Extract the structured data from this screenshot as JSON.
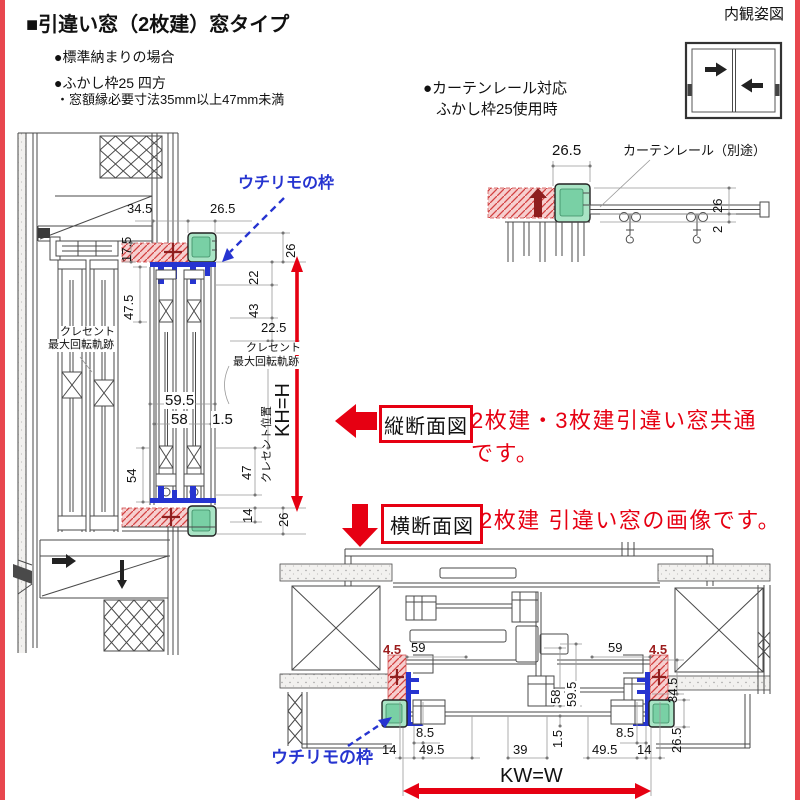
{
  "header": {
    "title": "■引違い窓（2枚建）窓タイプ",
    "bullet1": "●標準納まりの場合",
    "bullet2": "●ふかし枠25 四方",
    "note": "・窓額縁必要寸法35mm以上47mm未満"
  },
  "interior_view": {
    "label": "内観姿図"
  },
  "curtain": {
    "heading_line1": "●カーテンレール対応",
    "heading_line2": "ふかし枠25使用時",
    "dim_width": "26.5",
    "rail_label": "カーテンレール（別途）",
    "dim_26": "26",
    "dim_2": "2"
  },
  "vertical_section": {
    "uchirimo_label": "ウチリモの枠",
    "dim_34_5": "34.5",
    "dim_26_5": "26.5",
    "dim_17_5": "17.5",
    "dim_26_top": "26",
    "dim_22": "22",
    "dim_43": "43",
    "dim_47_5": "47.5",
    "dim_22_5": "22.5",
    "crescent_left_line1": "クレセント",
    "crescent_left_line2": "最大回転軌跡",
    "crescent_right_line1": "クレセント",
    "crescent_right_line2": "最大回転軌跡",
    "dim_59_5": "59.5",
    "dim_58": "58",
    "dim_1_5": "1.5",
    "dim_54": "54",
    "dim_47": "47",
    "crescent_pos_label": "クレセント位置",
    "kh_label": "KH=H",
    "dim_14": "14",
    "dim_26_bottom": "26"
  },
  "annotations": {
    "vertical_box": "縦断面図",
    "vertical_text_line1": "2枚建・3枚建引違い窓共通",
    "vertical_text_line2": "です。",
    "horizontal_box": "横断面図",
    "horizontal_text": "2枚建 引違い窓の画像です。"
  },
  "horizontal_section": {
    "uchirimo_label": "ウチリモの枠",
    "dim_4_5_left": "4.5",
    "dim_4_5_right": "4.5",
    "dim_59_left": "59",
    "dim_59_right": "59",
    "dim_8_5_left": "8.5",
    "dim_8_5_right": "8.5",
    "dim_49_5_left": "49.5",
    "dim_49_5_right": "49.5",
    "dim_14_left": "14",
    "dim_14_right": "14",
    "dim_39": "39",
    "dim_1_5": "1.5",
    "dim_58": "58",
    "dim_59_5": "59.5",
    "dim_34_5": "34.5",
    "dim_26_5": "26.5",
    "kw_label": "KW=W"
  },
  "colors": {
    "accent_red": "#e60012",
    "page_border_red": "#e8474e",
    "frame_blue": "#2634d0",
    "fukashi_green_fill": "#a9e4c5",
    "fukashi_green_inner": "#79d0a5",
    "hatch_pink": "#f6cfcf",
    "hatch_line": "#d34040"
  }
}
